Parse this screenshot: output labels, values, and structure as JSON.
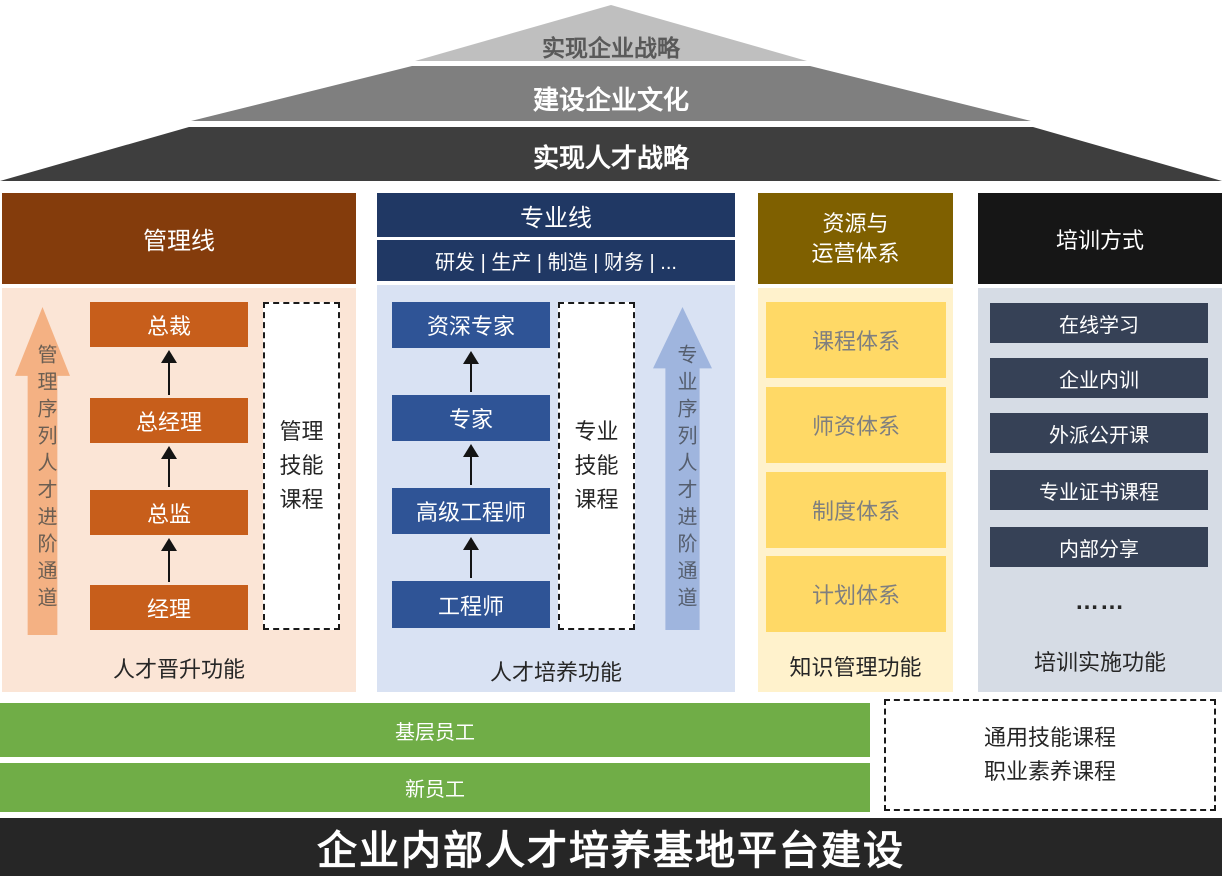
{
  "pyramid": {
    "levels": [
      {
        "label": "实现企业战略",
        "bg": "#BFBFBF",
        "text_color": "#595959"
      },
      {
        "label": "建设企业文化",
        "bg": "#7F7F7F",
        "text_color": "#FFFFFF"
      },
      {
        "label": "实现人才战略",
        "bg": "#3E3E3E",
        "text_color": "#FFFFFF"
      }
    ]
  },
  "columns": {
    "management": {
      "header": "管理线",
      "arrow_label": "管理序列人才进阶通道",
      "boxes": [
        "总裁",
        "总经理",
        "总监",
        "经理"
      ],
      "dashed_lines": [
        "管理",
        "技能",
        "课程"
      ],
      "footer": "人才晋升功能"
    },
    "professional": {
      "header": "专业线",
      "subheader": "研发 | 生产 | 制造 | 财务 | ...",
      "boxes": [
        "资深专家",
        "专家",
        "高级工程师",
        "工程师"
      ],
      "dashed_lines": [
        "专业",
        "技能",
        "课程"
      ],
      "arrow_label": "专业序列人才进阶通道",
      "footer": "人才培养功能"
    },
    "resources": {
      "header_lines": [
        "资源与",
        "运营体系"
      ],
      "boxes": [
        "课程体系",
        "师资体系",
        "制度体系",
        "计划体系"
      ],
      "footer": "知识管理功能"
    },
    "training": {
      "header": "培训方式",
      "boxes": [
        "在线学习",
        "企业内训",
        "外派公开课",
        "专业证书课程",
        "内部分享"
      ],
      "ellipsis": "……",
      "footer": "培训实施功能"
    }
  },
  "base": {
    "bars": [
      "基层员工",
      "新员工"
    ],
    "dashed_lines": [
      "通用技能课程",
      "职业素养课程"
    ]
  },
  "banner": "企业内部人才培养基地平台建设",
  "colors": {
    "pyramid_l1": "#BFBFBF",
    "pyramid_l2": "#7F7F7F",
    "pyramid_l3": "#3E3E3E",
    "management_header": "#843C0C",
    "management_body": "#FBE5D6",
    "management_box": "#C75E1B",
    "management_arrow": "#F4B183",
    "professional_header": "#203864",
    "professional_body": "#D9E2F3",
    "professional_box": "#2F5496",
    "professional_arrow": "#9FB5DE",
    "resources_header": "#7F6000",
    "resources_body": "#FFF2CC",
    "resources_box": "#FFD966",
    "training_header": "#161616",
    "training_body": "#D6DCE5",
    "training_box": "#364156",
    "green_bar": "#70AD47",
    "banner_bg": "#262626"
  }
}
